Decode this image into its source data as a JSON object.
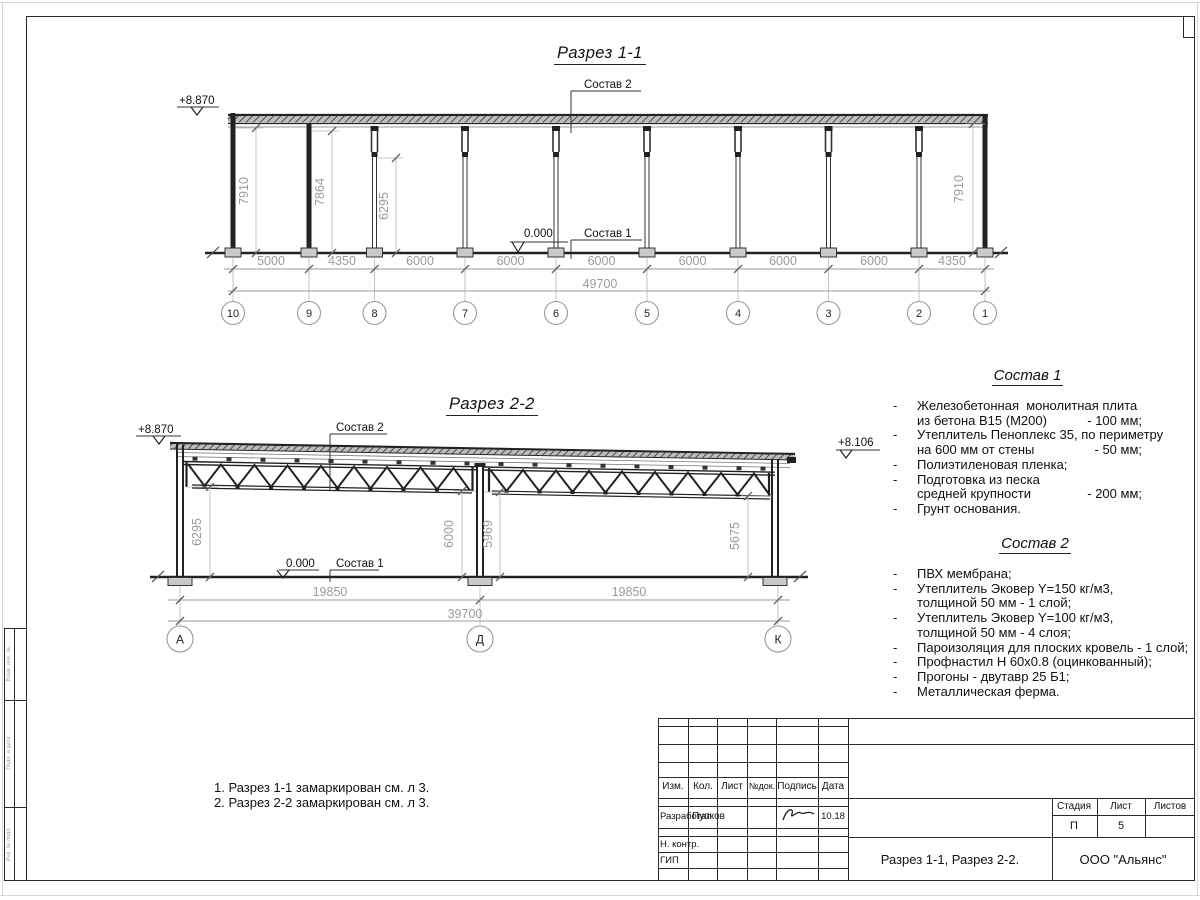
{
  "section1": {
    "title": "Разрез 1-1",
    "label_sostav2": "Состав 2",
    "label_sostav1": "Состав 1",
    "zero": "0.000",
    "elev_left": "+8.870",
    "dims_h": [
      "5000",
      "4350",
      "6000",
      "6000",
      "6000",
      "6000",
      "6000",
      "6000",
      "4350"
    ],
    "total": "49700",
    "dims_v": [
      "7910",
      "7864",
      "6295",
      "7910"
    ],
    "grids": [
      "10",
      "9",
      "8",
      "7",
      "6",
      "5",
      "4",
      "3",
      "2",
      "1"
    ]
  },
  "section2": {
    "title": "Разрез 2-2",
    "label_sostav2": "Состав 2",
    "label_sostav1": "Состав 1",
    "zero": "0.000",
    "elev_left": "+8.870",
    "elev_right": "+8.106",
    "dims_h": [
      "19850",
      "19850"
    ],
    "total": "39700",
    "dims_v": [
      "6295",
      "6000",
      "5969",
      "5675"
    ],
    "grids": [
      "А",
      "Д",
      "К"
    ]
  },
  "sostav1": {
    "title": "Состав 1",
    "lines": [
      {
        "d": "-",
        "t": "Железобетонная  монолитная плита",
        "v": ""
      },
      {
        "d": "",
        "t": "из бетона В15 (М200)",
        "v": "- 100 мм;"
      },
      {
        "d": "-",
        "t": "Утеплитель Пеноплекс 35, по периметру",
        "v": ""
      },
      {
        "d": "",
        "t": "на 600 мм от стены",
        "v": "- 50 мм;"
      },
      {
        "d": "-",
        "t": "Полиэтиленовая пленка;",
        "v": ""
      },
      {
        "d": "-",
        "t": "Подготовка из песка",
        "v": ""
      },
      {
        "d": "",
        "t": "средней крупности",
        "v": "- 200 мм;"
      },
      {
        "d": "-",
        "t": "Грунт основания.",
        "v": ""
      }
    ]
  },
  "sostav2": {
    "title": "Состав 2",
    "lines": [
      {
        "d": "-",
        "t": "ПВХ мембрана;",
        "v": ""
      },
      {
        "d": "-",
        "t": "Утеплитель Эковер Y=150 кг/м3,",
        "v": ""
      },
      {
        "d": "",
        "t": "толщиной 50 мм - 1 слой;",
        "v": ""
      },
      {
        "d": "-",
        "t": "Утеплитель Эковер Y=100 кг/м3,",
        "v": ""
      },
      {
        "d": "",
        "t": "толщиной 50 мм - 4 слоя;",
        "v": ""
      },
      {
        "d": "-",
        "t": "Пароизоляция для плоских кровель - 1 слой;",
        "v": ""
      },
      {
        "d": "-",
        "t": "Профнастил Н 60х0.8 (оцинкованный);",
        "v": ""
      },
      {
        "d": "-",
        "t": "Прогоны - двутавр 25 Б1;",
        "v": ""
      },
      {
        "d": "-",
        "t": "Металлическая ферма.",
        "v": ""
      }
    ]
  },
  "notes": {
    "n1": "1. Разрез 1-1 замаркирован см. л 3.",
    "n2": "2. Разрез 2-2 замаркирован см. л 3."
  },
  "stamp": {
    "cols": [
      "Изм.",
      "Кол.",
      "Лист",
      "№док.",
      "Подпись",
      "Дата"
    ],
    "developed_label": "Разработал",
    "developed_name": "Пупков",
    "date": "10.18",
    "ncontr": "Н. контр.",
    "gip": "ГИП",
    "stage_label": "Стадия",
    "sheet_label": "Лист",
    "sheets_label": "Листов",
    "stage": "П",
    "sheet_no": "5",
    "doc_title": "Разрез 1-1, Разрез 2-2.",
    "org": "ООО \"Альянс\""
  },
  "margin": {
    "labels": [
      "Взам. инв. №",
      "Подп. и дата",
      "Инв. № подл."
    ]
  }
}
